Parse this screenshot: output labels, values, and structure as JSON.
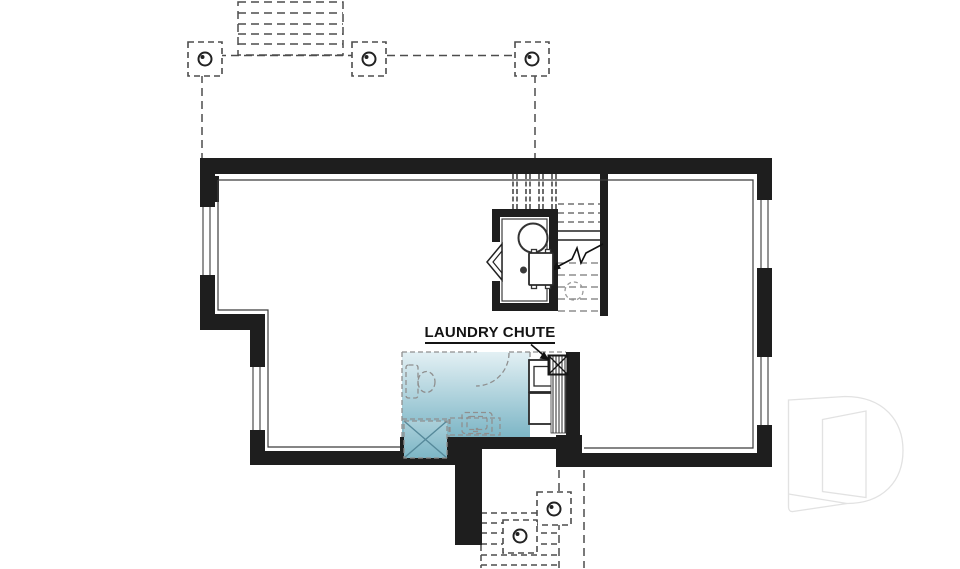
{
  "annotations": {
    "laundry_chute": {
      "text": "LAUNDRY CHUTE"
    }
  },
  "colors": {
    "background": "#ffffff",
    "wall": "#1e1e1e",
    "thin_line": "#3c3c3c",
    "deck_dash": "#4d4d4d",
    "fixture_dash": "#8f8f8f",
    "laundry_top": "#e3f0f4",
    "laundry_mid": "#abd0da",
    "laundry_bottom": "#7db6c6",
    "shower_cross": "#56899a",
    "watermark": "#e2e2e2",
    "label_text": "#141414"
  },
  "plan_elements": {
    "mechanical_room": [
      "water-heater",
      "furnace",
      "floor-drain",
      "bifold-doors"
    ],
    "future_laundry_bath": [
      "toilet",
      "shower",
      "vanity-sink",
      "door-swing",
      "washer",
      "dryer",
      "laundry-chute"
    ],
    "stairs": [
      "main-stairs-up",
      "stair-break-arrow",
      "sump-circle"
    ],
    "exterior": [
      "deck-posts",
      "deck-stairs-above",
      "walkout-stairs-below",
      "windows"
    ]
  }
}
